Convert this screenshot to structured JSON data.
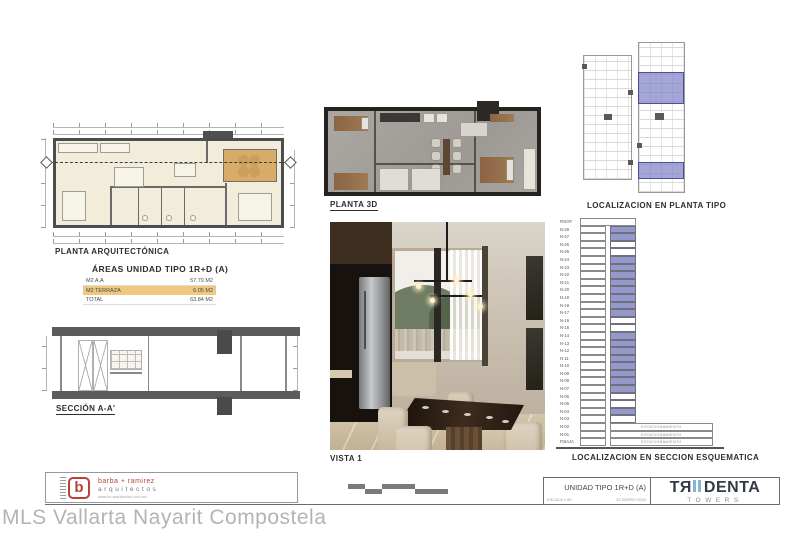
{
  "sheet": {
    "watermark": "MLS Vallarta Nayarit Compostela"
  },
  "plan": {
    "title": "PLANTA ARQUITECTÓNICA"
  },
  "section": {
    "title": "SECCIÓN A-A'"
  },
  "planta3d": {
    "title": "PLANTA  3D"
  },
  "vista": {
    "title": "VISTA 1"
  },
  "areas_table": {
    "title": "ÁREAS UNIDAD TIPO 1R+D (A)",
    "rows": [
      {
        "label": "M2 A.A",
        "value": "57.79 M2",
        "highlight": false
      },
      {
        "label": "M2 TERRAZA",
        "value": "6.05 M2",
        "highlight": true
      },
      {
        "label": "TOTAL",
        "value": "63.84 M2",
        "highlight": false
      }
    ]
  },
  "loc_planta": {
    "title": "LOCALIZACION EN PLANTA TIPO"
  },
  "loc_seccion": {
    "title": "LOCALIZACION EN SECCION ESQUEMATICA",
    "parking_label": "ESTACIONAMIENTO",
    "levels": [
      {
        "name": "ROOF",
        "state": "roof"
      },
      {
        "name": "N-28",
        "state": "hl"
      },
      {
        "name": "N-27",
        "state": "hl"
      },
      {
        "name": "N-26",
        "state": "w"
      },
      {
        "name": "N-25",
        "state": "w"
      },
      {
        "name": "N-24",
        "state": "hl"
      },
      {
        "name": "N-23",
        "state": "hl"
      },
      {
        "name": "N-22",
        "state": "hl"
      },
      {
        "name": "N-21",
        "state": "hl"
      },
      {
        "name": "N-20",
        "state": "hl"
      },
      {
        "name": "N-19",
        "state": "hl"
      },
      {
        "name": "N-18",
        "state": "hl"
      },
      {
        "name": "N-17",
        "state": "hl"
      },
      {
        "name": "N-16",
        "state": "w"
      },
      {
        "name": "N-15",
        "state": "w"
      },
      {
        "name": "N-14",
        "state": "hl"
      },
      {
        "name": "N-13",
        "state": "hl"
      },
      {
        "name": "N-12",
        "state": "hl"
      },
      {
        "name": "N-11",
        "state": "hl"
      },
      {
        "name": "N-10",
        "state": "hl"
      },
      {
        "name": "N-09",
        "state": "hl"
      },
      {
        "name": "N-08",
        "state": "hl"
      },
      {
        "name": "N-07",
        "state": "hl"
      },
      {
        "name": "N-06",
        "state": "w"
      },
      {
        "name": "N-05",
        "state": "w"
      },
      {
        "name": "N-04",
        "state": "hl"
      },
      {
        "name": "N-03",
        "state": "w"
      },
      {
        "name": "N-02",
        "state": "park"
      },
      {
        "name": "N-01",
        "state": "park"
      },
      {
        "name": "P.BAJA",
        "state": "park"
      }
    ]
  },
  "titleblock": {
    "firm_line1": "barba + ramirez",
    "firm_line2": "arquitectos",
    "firm_url": "www.br-arquitectos.com.mx",
    "firm_mark": "b",
    "unit_title": "UNIDAD TIPO 1R+D (A)",
    "scale": "ESCALA 1:50",
    "date": "22 ENERO  2020",
    "brand_left": "TЯ",
    "brand_right": "DENTA",
    "brand_sub": "TOWERS"
  },
  "colors": {
    "highlight_purple": "#9598cd",
    "terrace_tan": "#d9ab69",
    "table_highlight_tan": "#eec87e",
    "brand_blue": "#85b4d6",
    "firm_red": "#b4443a"
  }
}
